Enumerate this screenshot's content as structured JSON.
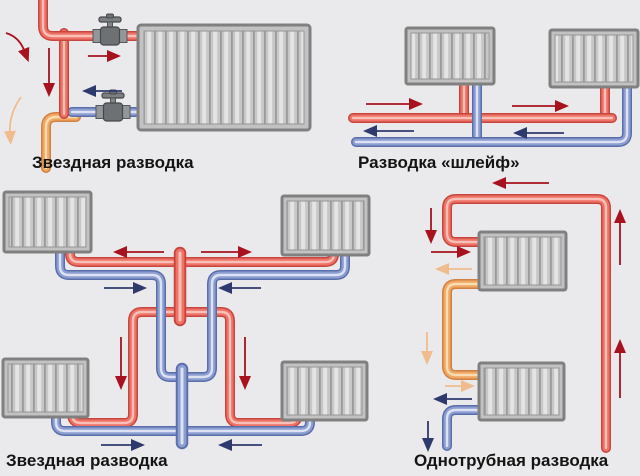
{
  "panels": [
    {
      "id": "star-single",
      "label": "Звездная разводка"
    },
    {
      "id": "loop",
      "label": "Разводка «шлейф»"
    },
    {
      "id": "star-multi",
      "label": "Звездная разводка"
    },
    {
      "id": "one-pipe",
      "label": "Однотрубная разводка"
    }
  ],
  "colors": {
    "background": "#eaeaec",
    "supply_pipe": "#ee7266",
    "supply_pipe_edge": "#c8453d",
    "return_pipe": "#8c9ed0",
    "return_pipe_edge": "#5a6dab",
    "mixed_pipe": "#efa763",
    "mixed_pipe_edge": "#d08040",
    "supply_arrow": "#a8121f",
    "return_arrow": "#2e3a6e",
    "mixed_arrow": "#f0bc8e",
    "radiator_fill": "#c7c7c7",
    "radiator_border": "#808080",
    "label_text": "#141414"
  }
}
